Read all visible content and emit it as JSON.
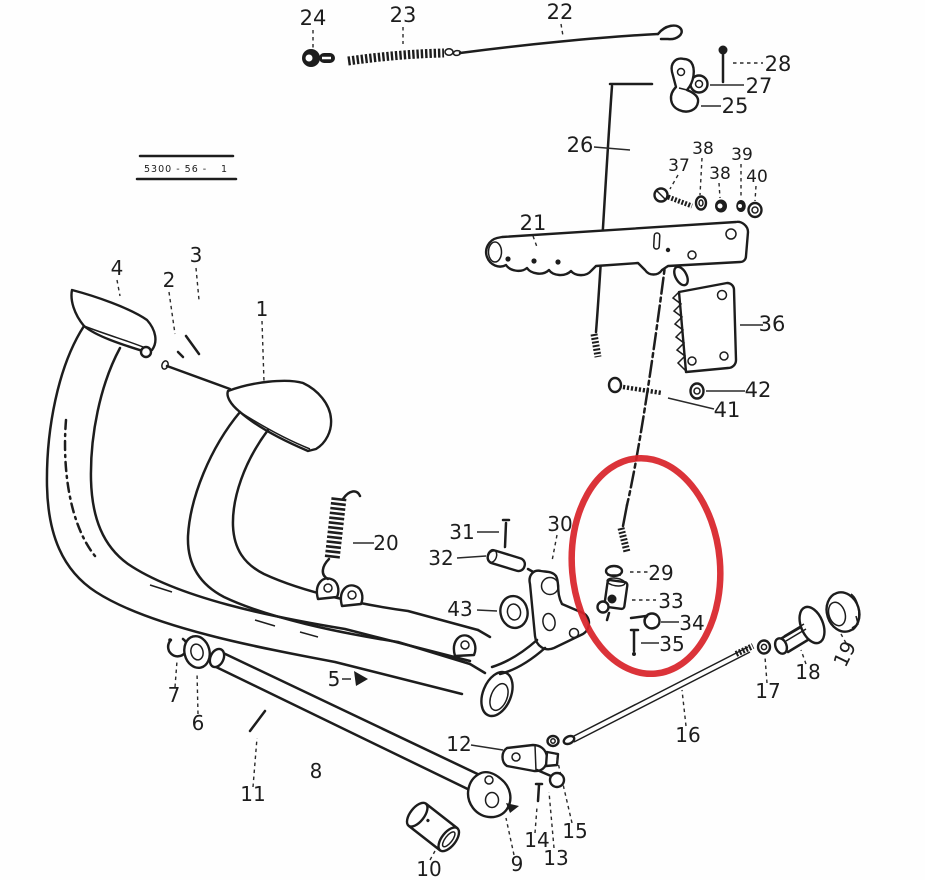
{
  "figure": {
    "type": "exploded-parts-diagram",
    "title_block": {
      "code": "5300 - 56 -",
      "sheet": "1"
    },
    "highlight": {
      "color": "#d8232a",
      "shape": "ellipse",
      "circled_part_numbers": [
        "29",
        "33",
        "34",
        "35"
      ]
    },
    "ink": "#1d1d1d",
    "background": "#fefefe"
  },
  "part_labels": {
    "1": "1",
    "2": "2",
    "3": "3",
    "4": "4",
    "5": "5",
    "6": "6",
    "7": "7",
    "8": "8",
    "9": "9",
    "10": "10",
    "11": "11",
    "12": "12",
    "13": "13",
    "14": "14",
    "15": "15",
    "16": "16",
    "17": "17",
    "18": "18",
    "19": "19",
    "20": "20",
    "21": "21",
    "22": "22",
    "23": "23",
    "24": "24",
    "25": "25",
    "26": "26",
    "27": "27",
    "28": "28",
    "29": "29",
    "30": "30",
    "31": "31",
    "32": "32",
    "33": "33",
    "34": "34",
    "35": "35",
    "36": "36",
    "37": "37",
    "38": "38",
    "39": "39",
    "40": "40",
    "41": "41",
    "42": "42",
    "43": "43"
  }
}
